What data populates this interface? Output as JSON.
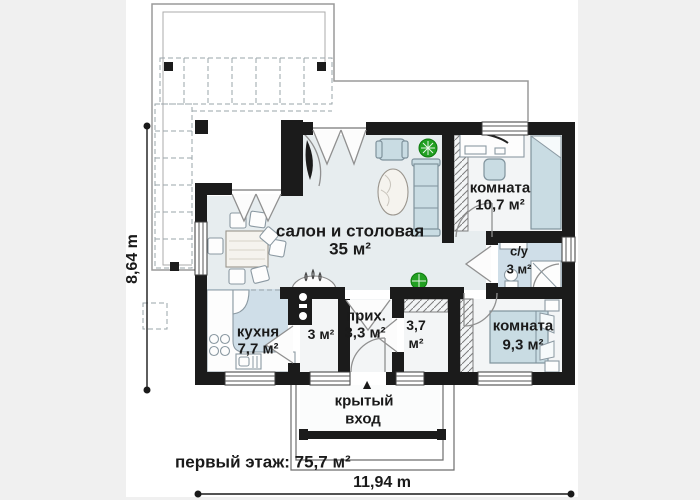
{
  "colors": {
    "page_bg": "#f0f0f0",
    "canvas": "#ffffff",
    "wall": "#1b1b1b",
    "floor": "#e7edef",
    "blue_floor": "#cfdee8",
    "hall_floor": "#f3f5f6",
    "furniture": "#c9dce3",
    "furniture_outline": "#7f929c",
    "plant": "#22a022",
    "dashed": "#9aa4aa"
  },
  "rooms": {
    "living": {
      "name": "салон и столовая",
      "area": "35 м²"
    },
    "room_top": {
      "name": "комната",
      "area": "10,7 м²"
    },
    "bathroom": {
      "name": "с/у",
      "area": "3 м²"
    },
    "room_bottom": {
      "name": "комната",
      "area": "9,3 м²"
    },
    "kitchen": {
      "name": "кухня",
      "area": "7,7 м²"
    },
    "pantry": {
      "area": "3 м²"
    },
    "hallway": {
      "name": "прих.",
      "area": "3,3 м²"
    },
    "wardrobe": {
      "area": "3,7",
      "unit": "м²"
    }
  },
  "entrance": {
    "line1": "крытый",
    "line2": "вход",
    "arrow": "▲"
  },
  "dimensions": {
    "height_label": "8,64 m",
    "width_label": "11,94 m",
    "floor_total": "первый этаж: 75,7 м²"
  },
  "icons": {
    "plant": "plant-icon",
    "fireplace": "fireplace-icon",
    "entrance_arrow": "entrance-arrow-icon"
  }
}
